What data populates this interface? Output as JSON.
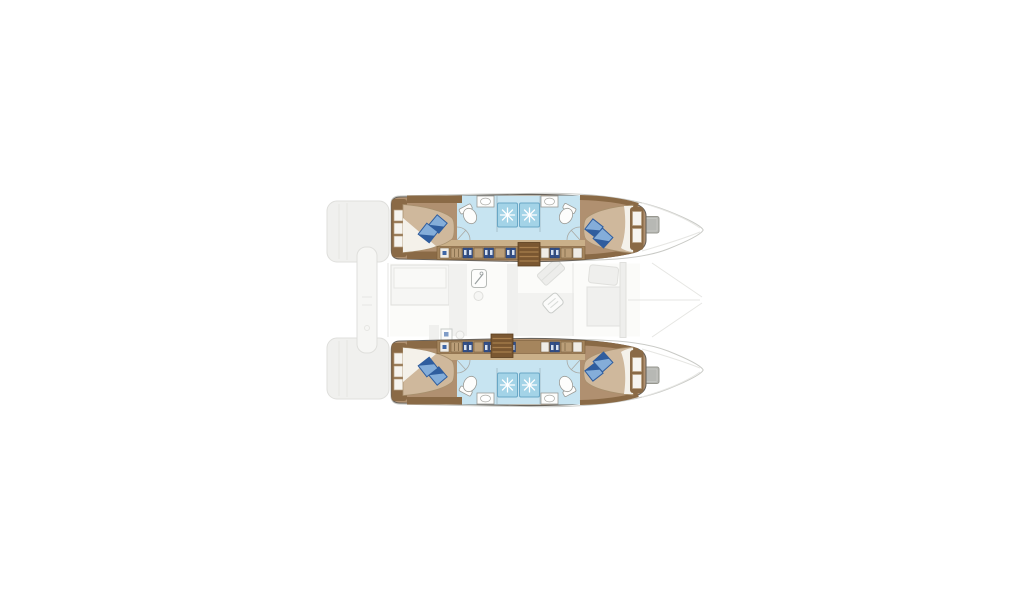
{
  "meta": {
    "type": "catamaran-yacht-floor-plan-top-view",
    "visible_text": []
  },
  "colors": {
    "bg": "#ffffff",
    "hull_outline": "#6a645c",
    "bow_outline": "#c9cac6",
    "faint_fill": "#f0f0ee",
    "faint_fill2": "#f6f6f4",
    "faint_line": "#dfdfdc",
    "faint_line2": "#e6e6e3",
    "wood_floor": "#b09070",
    "wood_dark": "#8a6a46",
    "wood_trim_dark": "#7c5f3d",
    "wood_cabinet": "#a5855d",
    "wood_drawer": "#bb9e78",
    "corridor": "#cab089",
    "bed": "#cfb89c",
    "bed_line": "#a8906e",
    "sheet": "#f4f1ea",
    "pillow_light": "#84add9",
    "pillow_dark": "#2f5d9e",
    "bath_floor": "#c7e4f1",
    "shower": "#a3d3e7",
    "shower_line": "#69a7c6",
    "fixture": "#fdfdfc",
    "fixture_line": "#9a9a95",
    "steps": "#7a5731",
    "steps_line": "#5b3f20",
    "steps_tread": "#a87f4e",
    "hatch": "#b7b8b4",
    "hatch_line": "#97978f",
    "washer_blue": "#33508c",
    "glyph_blue": "#3d65a5",
    "white_slat": "#f6f4ef",
    "slat_line": "#b9a183"
  },
  "plan": {
    "hulls": [
      {
        "id": "top",
        "parts": [
          "aft-cabin-double-bed",
          "headboard-shelves",
          "aft-bathroom",
          "twin-showers",
          "forward-bathroom",
          "forward-cabin-double-bed",
          "forward-shelves",
          "cabinet-row",
          "companionway-steps",
          "bow-hatch"
        ]
      },
      {
        "id": "bottom",
        "parts": [
          "aft-cabin-double-bed",
          "headboard-shelves",
          "aft-bathroom",
          "twin-showers",
          "forward-bathroom",
          "forward-cabin-double-bed",
          "forward-shelves",
          "cabinet-row",
          "companionway-steps",
          "bow-hatch"
        ]
      }
    ],
    "deck_faint": [
      "stern-platform-top",
      "stern-platform-bottom",
      "davit-bar",
      "saloon",
      "galley-counter",
      "galley-sink",
      "dinette-table",
      "chart-seat",
      "diagonal-bench",
      "forward-crossbeam",
      "bowsprit-lines"
    ],
    "counts": {
      "cabins": 4,
      "double_beds": 4,
      "pillows": 8,
      "bathrooms": 4,
      "showers": 4,
      "toilets": 4,
      "sinks": 4,
      "companionways": 2,
      "bow_hatches": 2
    }
  },
  "icons": {
    "shower_jet": "white starburst on blue square",
    "toilet": "white oval with tank",
    "sink": "white counter with oval basin",
    "washer": "navy square with white panel",
    "bow_hatch": "gray rounded square",
    "pillow": "rotated two-tone blue square"
  }
}
